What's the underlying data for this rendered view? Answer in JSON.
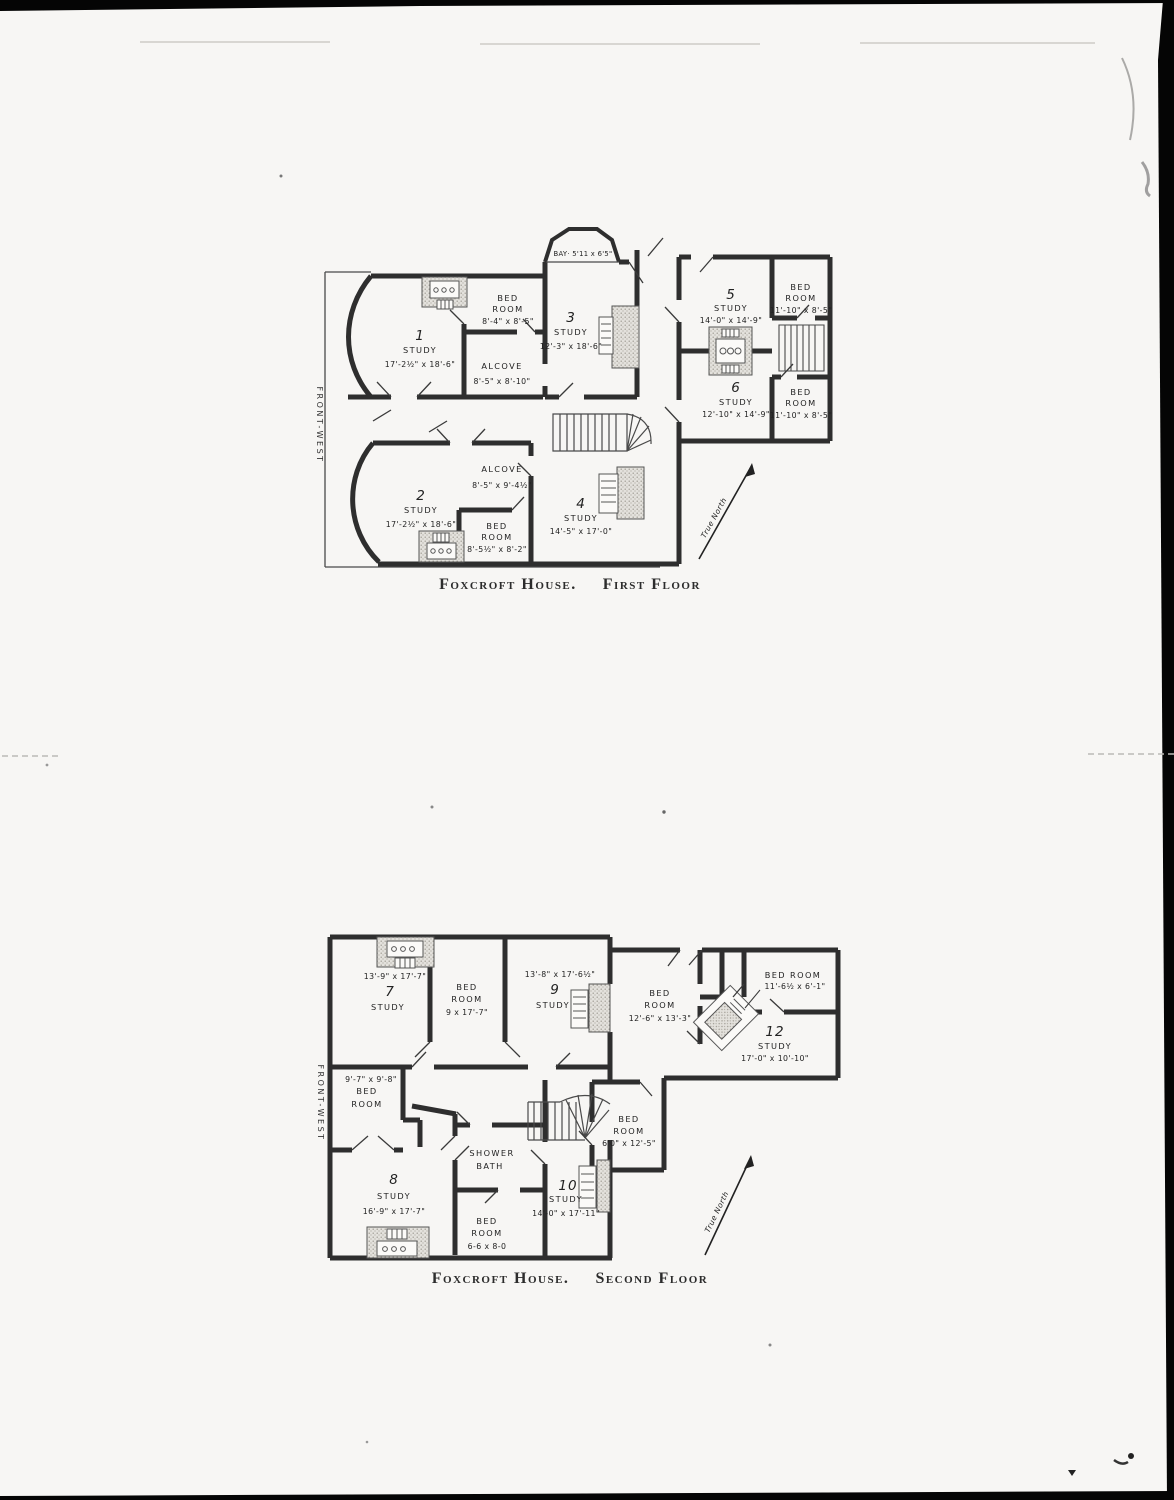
{
  "document": {
    "type": "scanned floor plan page",
    "building": "Foxcroft House",
    "ink_color": "#2e2e2e",
    "paper_color": "#f7f6f4"
  },
  "floor1": {
    "caption": {
      "title": "Foxcroft House.",
      "subtitle": "First Floor"
    },
    "front_label": "FRONT-WEST",
    "north_label": "True North",
    "bay_label": "BAY· 5'11 x 6'5\"",
    "study1": {
      "no": "1",
      "name": "STUDY",
      "dims": "17'-2½\" x 18'-6\""
    },
    "bed_nw": {
      "name1": "BED",
      "name2": "ROOM",
      "dims": "8'-4\" x 8'-5\""
    },
    "alcove_n": {
      "name": "ALCOVE",
      "dims": "8'-5\" x 8'-10\""
    },
    "study3": {
      "no": "3",
      "name": "STUDY",
      "dims": "12'-3\" x 18'-6\""
    },
    "study5": {
      "no": "5",
      "name": "STUDY",
      "dims": "14'-0\" x 14'-9\""
    },
    "bed_ne": {
      "name1": "BED",
      "name2": "ROOM",
      "dims": "11'-10\" x 8'-5\""
    },
    "study6": {
      "no": "6",
      "name": "STUDY",
      "dims": "12'-10\" x 14'-9\""
    },
    "bed_se": {
      "name1": "BED",
      "name2": "ROOM",
      "dims": "11'-10\" x 8'-5\""
    },
    "study2": {
      "no": "2",
      "name": "STUDY",
      "dims": "17'-2½\" x 18'-6\""
    },
    "alcove_s": {
      "name": "ALCOVE",
      "dims": "8'-5\" x 9'-4½\""
    },
    "bed_sw": {
      "name1": "BED",
      "name2": "ROOM",
      "dims": "8'-5½\" x 8'-2\""
    },
    "study4": {
      "no": "4",
      "name": "STUDY",
      "dims": "14'-5\" x 17'-0\""
    }
  },
  "floor2": {
    "caption": {
      "title": "Foxcroft House.",
      "subtitle": "Second Floor"
    },
    "front_label": "FRONT-WEST",
    "north_label": "True North",
    "study7": {
      "dims": "13'-9\" x 17'-7\"",
      "no": "7",
      "name": "STUDY"
    },
    "bed_n": {
      "name1": "BED",
      "name2": "ROOM",
      "dims": "9 x 17'-7\""
    },
    "study9": {
      "dims": "13'-8\" x 17'-6½\"",
      "no": "9",
      "name": "STUDY"
    },
    "bed_c": {
      "name1": "BED",
      "name2": "ROOM",
      "dims": "12'-6\" x 13'-3\""
    },
    "bed_ne": {
      "name1": "BED ROOM",
      "dims": "11'-6½ x 6'-1\""
    },
    "study12": {
      "no": "12",
      "name": "STUDY",
      "dims": "17'-0\" x 10'-10\""
    },
    "bed_w": {
      "dims": "9'-7\" x 9'-8\"",
      "name1": "BED",
      "name2": "ROOM"
    },
    "shower": {
      "name1": "SHOWER",
      "name2": "BATH"
    },
    "study8": {
      "no": "8",
      "name": "STUDY",
      "dims": "16'-9\" x 17'-7\""
    },
    "bed_s": {
      "name1": "BED",
      "name2": "ROOM",
      "dims": "6-6 x 8-0"
    },
    "study10": {
      "no": "10",
      "name": "STUDY",
      "dims": "14'-0\" x 17'-11\""
    },
    "bed_e": {
      "name1": "BED",
      "name2": "ROOM",
      "dims": "6'0\" x 12'-5\""
    }
  }
}
